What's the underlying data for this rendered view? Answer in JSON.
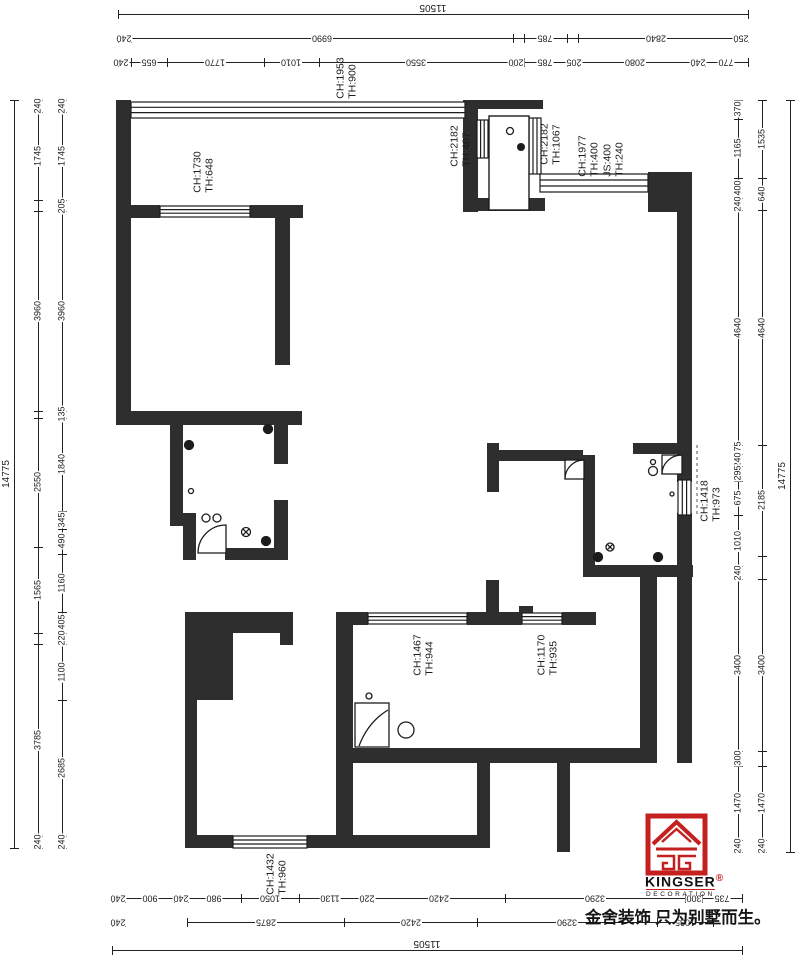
{
  "colors": {
    "wall": "#2e2e2e",
    "line": "#222222",
    "logo_red": "#c4201f"
  },
  "branding": {
    "logo_text": "KINGSER",
    "logo_mark": "®",
    "logo_sub": "DECORATION",
    "tagline": "金舍装饰 只为别墅而生。"
  },
  "room_labels": [
    {
      "name": "label-ch1953",
      "x": 347,
      "y": 78,
      "lines": [
        "CH:1953",
        "TH:900"
      ]
    },
    {
      "name": "label-ch1730",
      "x": 204,
      "y": 172,
      "lines": [
        "CH:1730",
        "TH:648"
      ]
    },
    {
      "name": "label-ch2182a",
      "x": 461,
      "y": 146,
      "lines": [
        "CH:2182",
        "TH:407"
      ]
    },
    {
      "name": "label-ch2182b",
      "x": 551,
      "y": 144,
      "lines": [
        "CH:2182",
        "TH:1067"
      ]
    },
    {
      "name": "label-ch1977",
      "x": 601,
      "y": 156,
      "lines": [
        "CH:1977",
        "TH:400",
        "JS:400",
        "TH:240"
      ]
    },
    {
      "name": "label-ch1418",
      "x": 711,
      "y": 501,
      "lines": [
        "CH:1418",
        "TH:973"
      ]
    },
    {
      "name": "label-ch1467",
      "x": 424,
      "y": 655,
      "lines": [
        "CH:1467",
        "TH:944"
      ]
    },
    {
      "name": "label-ch1170",
      "x": 548,
      "y": 655,
      "lines": [
        "CH:1170",
        "TH:935"
      ]
    },
    {
      "name": "label-ch1432",
      "x": 277,
      "y": 874,
      "lines": [
        "CH:1432",
        "TH:960"
      ]
    }
  ],
  "dim_chains": [
    {
      "o": "h",
      "pos": 14,
      "a": 118,
      "b": 748,
      "fs": 10,
      "ticks": [
        118,
        748
      ],
      "labels": [
        {
          "t": "11505",
          "p": 433,
          "n": -7
        }
      ]
    },
    {
      "o": "h",
      "pos": 38,
      "a": 118,
      "b": 748,
      "ticks": [
        118,
        131,
        513,
        524,
        567,
        578,
        735,
        748
      ],
      "labels": [
        {
          "t": "240",
          "p": 124
        },
        {
          "t": "6990",
          "p": 322
        },
        {
          "t": "785",
          "p": 545
        },
        {
          "t": "2840",
          "p": 656
        },
        {
          "t": "250",
          "p": 741
        }
      ]
    },
    {
      "o": "h",
      "pos": 62,
      "a": 118,
      "b": 748,
      "ticks": [
        118,
        131,
        167,
        264,
        319,
        513,
        524,
        567,
        578,
        692,
        705,
        748
      ],
      "labels": [
        {
          "t": "240",
          "p": 121
        },
        {
          "t": "655",
          "p": 149
        },
        {
          "t": "1770",
          "p": 215
        },
        {
          "t": "1010",
          "p": 291
        },
        {
          "t": "3550",
          "p": 416
        },
        {
          "t": "200",
          "p": 516
        },
        {
          "t": "785",
          "p": 545
        },
        {
          "t": "205",
          "p": 574
        },
        {
          "t": "2080",
          "p": 635
        },
        {
          "t": "240",
          "p": 698
        },
        {
          "t": "770",
          "p": 726
        }
      ]
    },
    {
      "o": "h",
      "pos": 898,
      "a": 112,
      "b": 742,
      "ticks": [
        112,
        125,
        174,
        188,
        241,
        299,
        361,
        373,
        505,
        685,
        702,
        742
      ],
      "labels": [
        {
          "t": "240",
          "p": 118
        },
        {
          "t": "900",
          "p": 150
        },
        {
          "t": "240",
          "p": 181
        },
        {
          "t": "980",
          "p": 214
        },
        {
          "t": "1050",
          "p": 270
        },
        {
          "t": "1130",
          "p": 330
        },
        {
          "t": "220",
          "p": 367
        },
        {
          "t": "2420",
          "p": 439
        },
        {
          "t": "3290",
          "p": 595
        },
        {
          "t": "300",
          "p": 694
        },
        {
          "t": "735",
          "p": 722
        }
      ]
    },
    {
      "o": "h",
      "pos": 922,
      "a": 112,
      "b": 125,
      "ticks": [
        112,
        125
      ],
      "labels": [
        {
          "t": "240",
          "p": 118
        }
      ]
    },
    {
      "o": "h",
      "pos": 922,
      "a": 187,
      "b": 713,
      "ticks": [
        187,
        344,
        477,
        657,
        713
      ],
      "labels": [
        {
          "t": "2875",
          "p": 266
        },
        {
          "t": "2420",
          "p": 411
        },
        {
          "t": "3290",
          "p": 567
        },
        {
          "t": "1035",
          "p": 685
        }
      ]
    },
    {
      "o": "h",
      "pos": 950,
      "a": 112,
      "b": 742,
      "fs": 10,
      "ticks": [
        112,
        742
      ],
      "labels": [
        {
          "t": "11505",
          "p": 427,
          "n": -7
        }
      ]
    },
    {
      "o": "v",
      "pos": 14,
      "a": 100,
      "b": 848,
      "fs": 10,
      "ticks": [
        100,
        848
      ],
      "labels": [
        {
          "t": "14775",
          "p": 474,
          "n": -7
        }
      ]
    },
    {
      "o": "v",
      "pos": 38,
      "a": 100,
      "b": 848,
      "ticks": [
        100,
        112,
        200,
        211,
        411,
        418,
        547,
        633,
        644,
        836,
        848
      ],
      "labels": [
        {
          "t": "240",
          "p": 106
        },
        {
          "t": "1745",
          "p": 156
        },
        {
          "t": "3960",
          "p": 311
        },
        {
          "t": "2550",
          "p": 482
        },
        {
          "t": "1565",
          "p": 590
        },
        {
          "t": "3785",
          "p": 740
        },
        {
          "t": "240",
          "p": 842
        }
      ]
    },
    {
      "o": "v",
      "pos": 62,
      "a": 100,
      "b": 848,
      "ticks": [
        100,
        112,
        200,
        211,
        411,
        418,
        511,
        529,
        554,
        612,
        633,
        644,
        700,
        836,
        848
      ],
      "labels": [
        {
          "t": "240",
          "p": 106
        },
        {
          "t": "1745",
          "p": 156
        },
        {
          "t": "205",
          "p": 206
        },
        {
          "t": "3960",
          "p": 311
        },
        {
          "t": "135",
          "p": 414
        },
        {
          "t": "1840",
          "p": 464
        },
        {
          "t": "345",
          "p": 520
        },
        {
          "t": "490",
          "p": 541
        },
        {
          "t": "1160",
          "p": 583
        },
        {
          "t": "405",
          "p": 622
        },
        {
          "t": "220",
          "p": 638
        },
        {
          "t": "1100",
          "p": 672
        },
        {
          "t": "2685",
          "p": 768
        },
        {
          "t": "240",
          "p": 842
        }
      ]
    },
    {
      "o": "v",
      "pos": 738,
      "a": 100,
      "b": 852,
      "ticks": [
        100,
        119,
        178,
        198,
        210,
        445,
        454,
        466,
        481,
        515,
        566,
        579,
        751,
        766,
        840,
        852
      ],
      "labels": [
        {
          "t": "370",
          "p": 109
        },
        {
          "t": "1165",
          "p": 148
        },
        {
          "t": "400",
          "p": 188
        },
        {
          "t": "240",
          "p": 204
        },
        {
          "t": "4640",
          "p": 328
        },
        {
          "t": "175",
          "p": 449
        },
        {
          "t": "240",
          "p": 460
        },
        {
          "t": "295",
          "p": 473
        },
        {
          "t": "675",
          "p": 498
        },
        {
          "t": "1010",
          "p": 541
        },
        {
          "t": "240",
          "p": 573
        },
        {
          "t": "3400",
          "p": 665
        },
        {
          "t": "300",
          "p": 758
        },
        {
          "t": "1470",
          "p": 803
        },
        {
          "t": "240",
          "p": 846
        }
      ]
    },
    {
      "o": "v",
      "pos": 762,
      "a": 100,
      "b": 852,
      "ticks": [
        100,
        178,
        210,
        445,
        556,
        579,
        751,
        766,
        840,
        852
      ],
      "labels": [
        {
          "t": "1535",
          "p": 139
        },
        {
          "t": "640",
          "p": 194
        },
        {
          "t": "4640",
          "p": 328
        },
        {
          "t": "2185",
          "p": 500
        },
        {
          "t": "3400",
          "p": 665
        },
        {
          "t": "1470",
          "p": 803
        },
        {
          "t": "240",
          "p": 846
        }
      ]
    },
    {
      "o": "v",
      "pos": 790,
      "a": 100,
      "b": 852,
      "fs": 10,
      "ticks": [
        100,
        852
      ],
      "labels": [
        {
          "t": "14775",
          "p": 476,
          "n": -7
        }
      ]
    }
  ]
}
